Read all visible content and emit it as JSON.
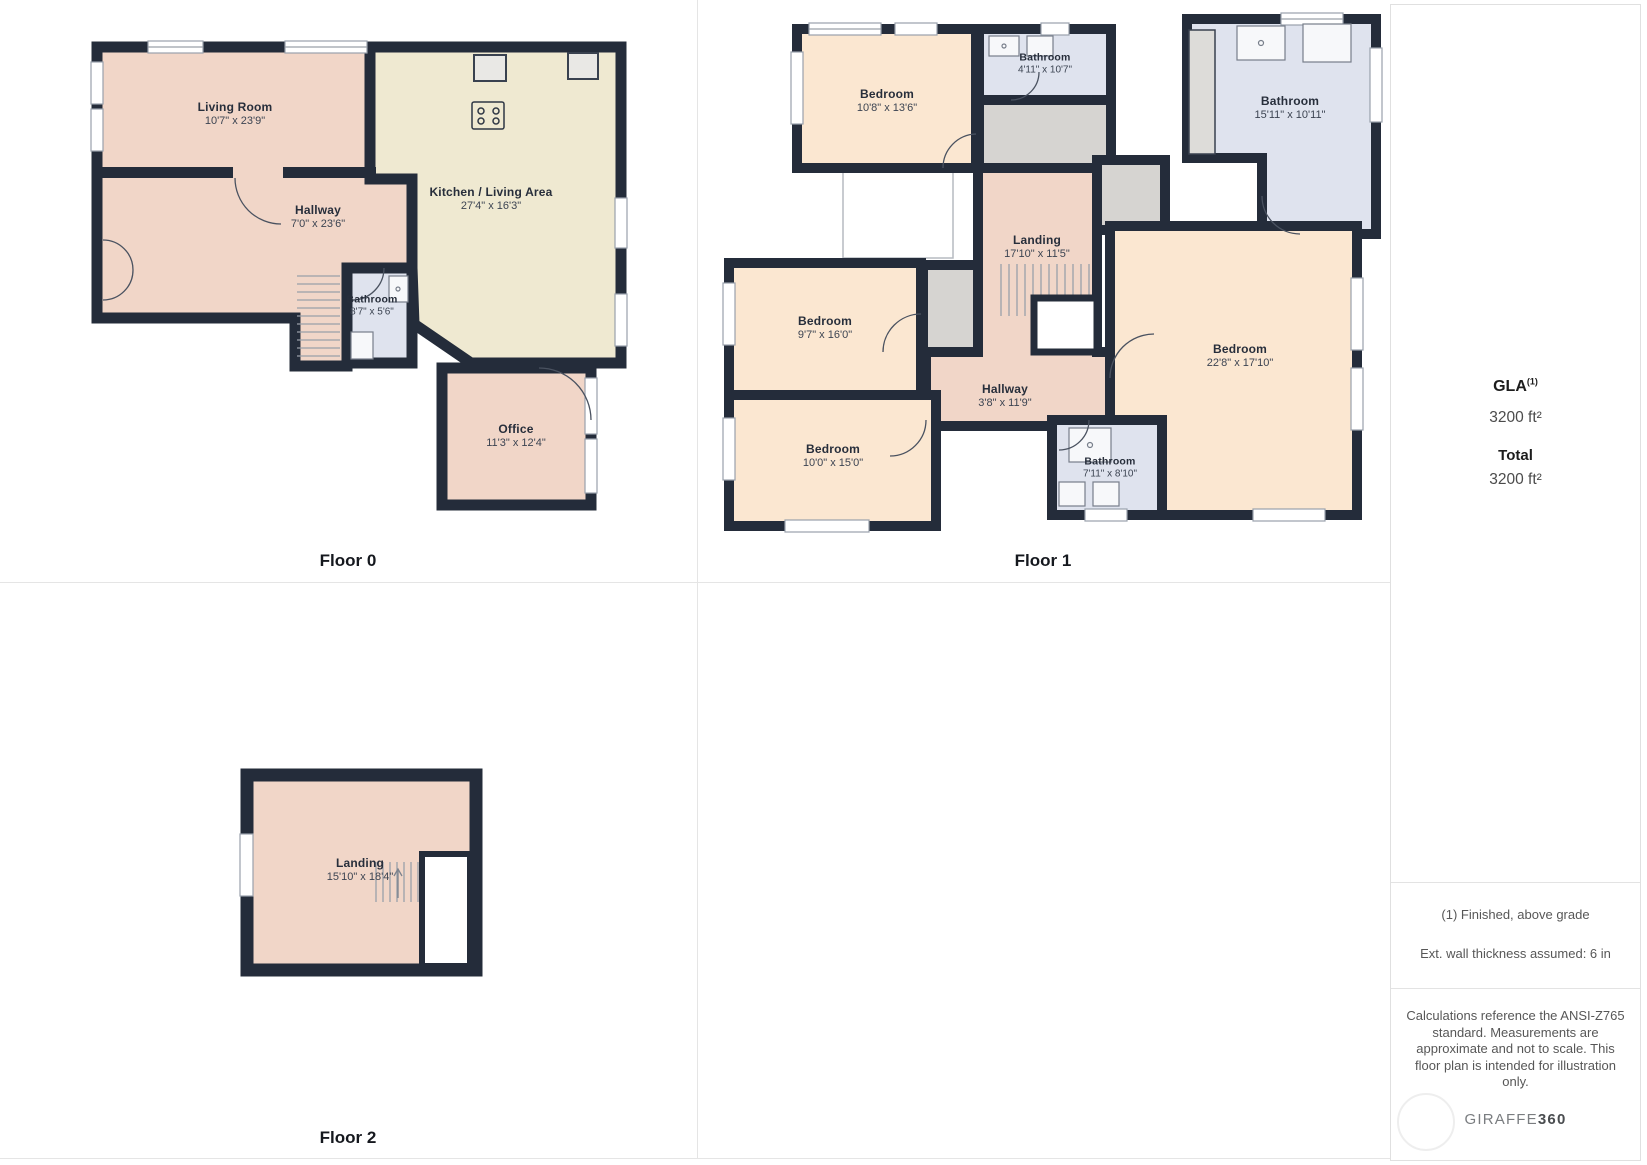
{
  "palette": {
    "wall": "#242c3a",
    "room_pink": "#f1d6c8",
    "room_peach": "#fbe7d1",
    "room_cream": "#efe9d1",
    "room_bath_blue": "#dfe3ee",
    "closet_gray": "#d6d4d1",
    "divider_gray": "#e5e5e5",
    "text_dark": "#1d2430",
    "text_muted": "#575757"
  },
  "floors": [
    {
      "label": "Floor 0",
      "rooms": [
        {
          "name": "Living Room",
          "dims": "10'7\" x 23'9\""
        },
        {
          "name": "Hallway",
          "dims": "7'0\" x 23'6\""
        },
        {
          "name": "Kitchen / Living Area",
          "dims": "27'4\" x 16'3\""
        },
        {
          "name": "Bathroom",
          "dims": "8'7\" x 5'6\""
        },
        {
          "name": "Office",
          "dims": "11'3\" x 12'4\""
        }
      ]
    },
    {
      "label": "Floor 1",
      "rooms": [
        {
          "name": "Bedroom",
          "dims": "10'8\" x 13'6\""
        },
        {
          "name": "Bathroom",
          "dims": "4'11\" x 10'7\""
        },
        {
          "name": "Bathroom",
          "dims": "15'11\" x 10'11\""
        },
        {
          "name": "Landing",
          "dims": "17'10\" x 11'5\""
        },
        {
          "name": "Bedroom",
          "dims": "9'7\" x 16'0\""
        },
        {
          "name": "Hallway",
          "dims": "3'8\" x 11'9\""
        },
        {
          "name": "Bedroom",
          "dims": "22'8\" x 17'10\""
        },
        {
          "name": "Bedroom",
          "dims": "10'0\" x 15'0\""
        },
        {
          "name": "Bathroom",
          "dims": "7'11\" x 8'10\""
        }
      ]
    },
    {
      "label": "Floor 2",
      "rooms": [
        {
          "name": "Landing",
          "dims": "15'10\" x 18'4\""
        }
      ]
    }
  ],
  "sidebar": {
    "gla_label": "GLA",
    "gla_sup": "(1)",
    "gla_value": "3200 ft²",
    "total_label": "Total",
    "total_value": "3200 ft²",
    "note_finished": "(1) Finished, above grade",
    "note_wall": "Ext. wall thickness assumed: 6 in",
    "disclaimer": "Calculations reference the ANSI-Z765 standard. Measurements are approximate and not to scale. This floor plan is intended for illustration only.",
    "brand_a": "GIRAFFE",
    "brand_b": "360"
  }
}
